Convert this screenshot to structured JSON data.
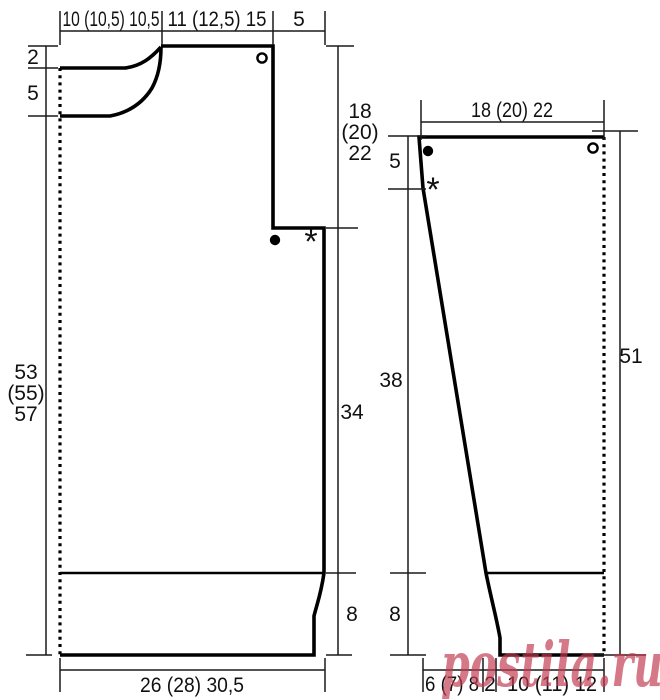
{
  "diagram": "knitting-pattern-schematic",
  "front": {
    "top": {
      "seg1": "10 (10,5) 10,5",
      "seg2": "11 (12,5) 15",
      "seg3": "5"
    },
    "left": {
      "back_neck_depth": "2",
      "front_neck_depth": "5",
      "length": [
        "53",
        "(55)",
        "57"
      ]
    },
    "right": {
      "yoke": [
        "18",
        "(20)",
        "22"
      ],
      "body": "34",
      "ribbing": "8"
    },
    "bottom": {
      "width": "26 (28) 30,5"
    }
  },
  "sleeve": {
    "top": {
      "width": "18 (20) 22"
    },
    "left": {
      "cap": "5",
      "upper": "38",
      "ribbing": "8"
    },
    "right": {
      "length": "51"
    },
    "bottom": {
      "seg1": "6 (7) 8",
      "seg2": "2",
      "seg3": "10 (11) 12"
    }
  },
  "markers": {
    "asterisk": "*"
  },
  "watermark": {
    "text": "postila.ru",
    "color": "#c23a52",
    "opacity": "0.68"
  },
  "colors": {
    "line": "#000000",
    "background": "#ffffff"
  }
}
